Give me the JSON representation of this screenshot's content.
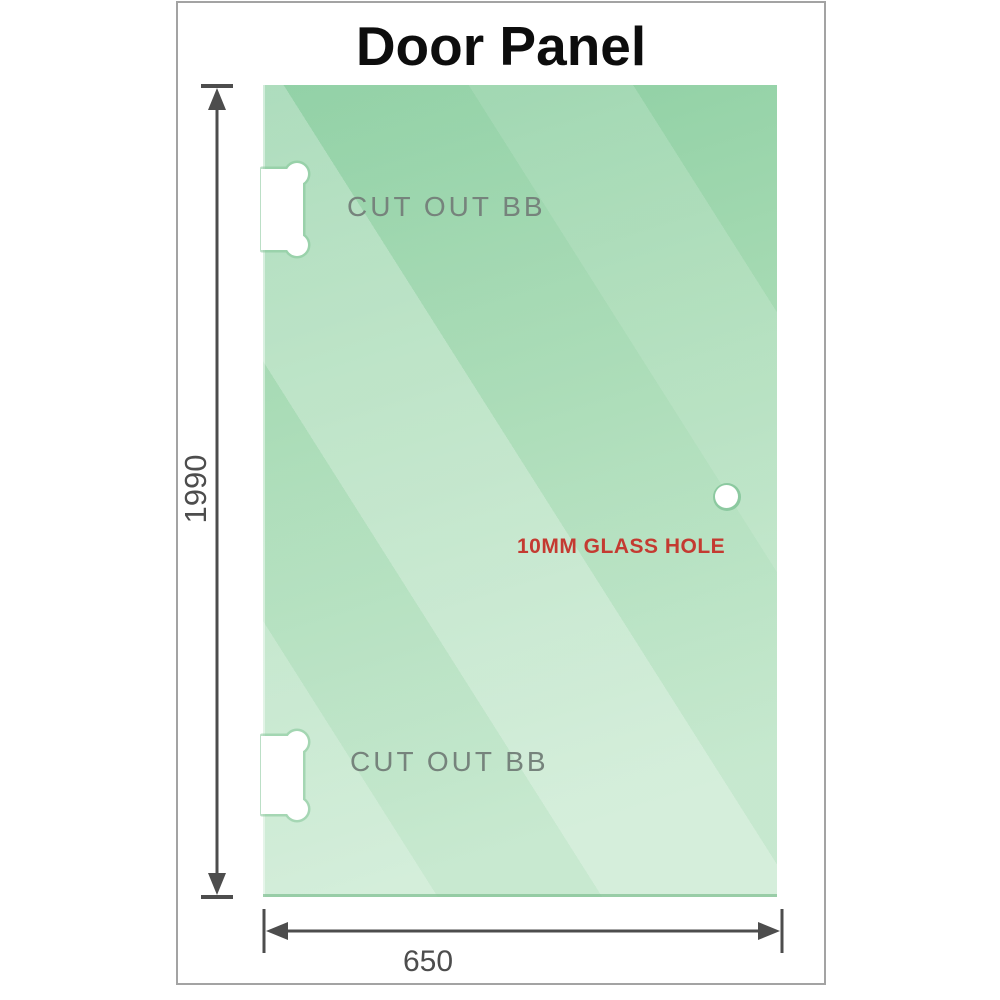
{
  "title": "Door Panel",
  "panel": {
    "cutout_top_label": "CUT OUT BB",
    "cutout_bottom_label": "CUT OUT BB",
    "hole_label": "10MM GLASS HOLE"
  },
  "dimensions": {
    "height": "1990",
    "width": "650"
  },
  "colors": {
    "glass_green_dark": "#8bcea1",
    "glass_green_mid": "#a3d9b1",
    "glass_green_light": "#c3e7cc",
    "dimension_line": "#4d4d4d",
    "cutout_label": "#76837c",
    "hole_label_red": "#c43a31",
    "frame_border": "#a3a3a3",
    "title_text": "#0d0d0d"
  }
}
